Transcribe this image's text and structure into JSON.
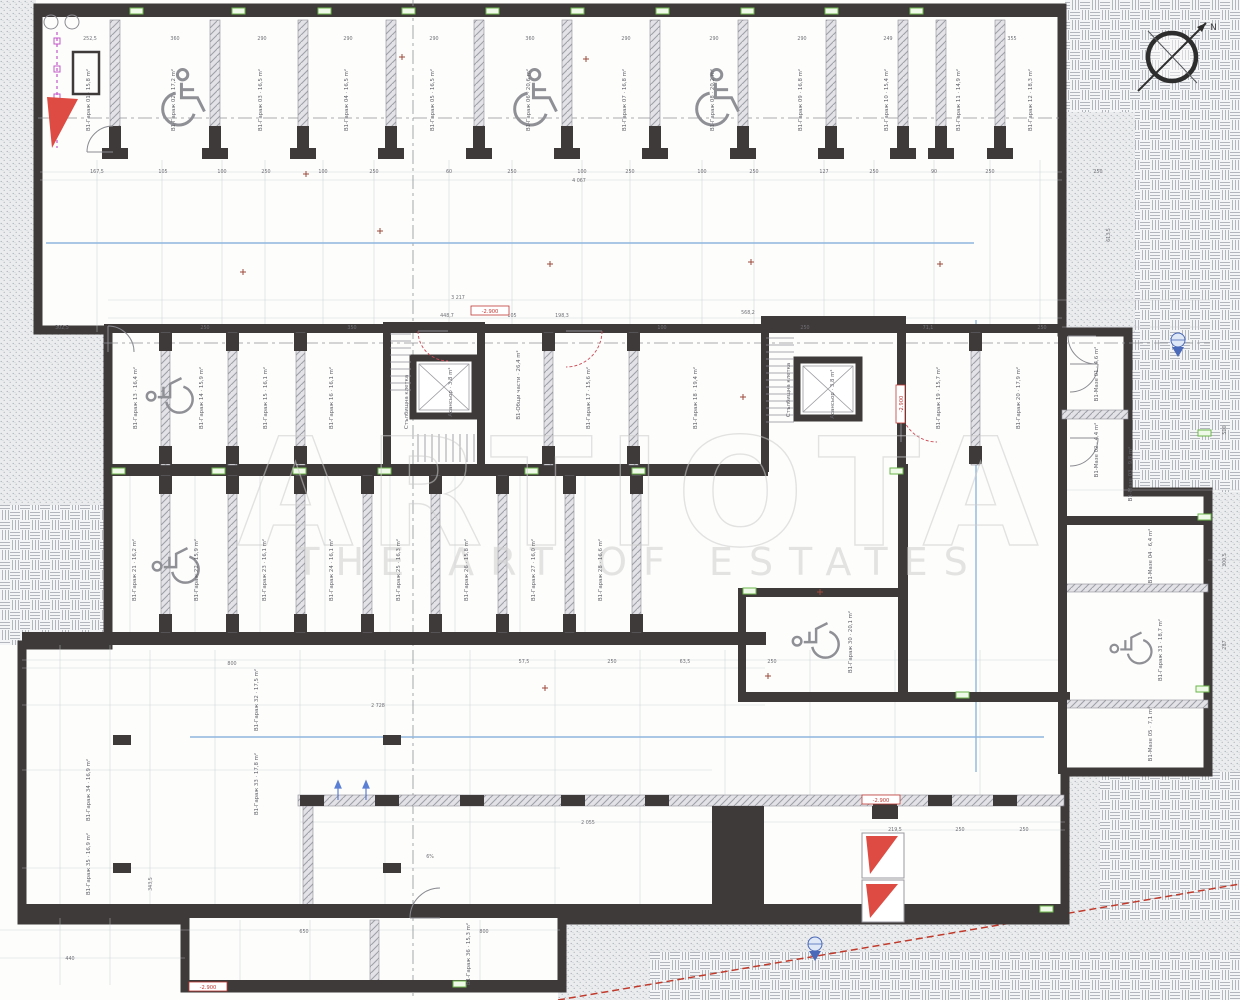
{
  "title": "Underground garage level floor plan",
  "watermark": {
    "brand": "ARTIOTA",
    "tagline": "THE ART OF ESTATES"
  },
  "compass": {
    "north_label": "N"
  },
  "colors": {
    "wall": "#3f3a3a",
    "ramp_red": "#dd4b43",
    "marker_green": "#6cb64a",
    "guide_blue": "#8fb6de",
    "utility_magenta": "#c257c8",
    "level_red": "#c03934"
  },
  "legend": {
    "dim_format": "[text, x, y, rot]"
  },
  "levels": [
    [
      "-2.900",
      490,
      313,
      0
    ],
    [
      "-2.900",
      903,
      404,
      -90
    ],
    [
      "-2.900",
      881,
      802,
      0
    ],
    [
      "-2.900",
      208,
      989,
      0
    ]
  ],
  "dims": [
    [
      "252,5",
      90,
      40,
      0
    ],
    [
      "360",
      175,
      40,
      0
    ],
    [
      "290",
      262,
      40,
      0
    ],
    [
      "290",
      348,
      40,
      0
    ],
    [
      "290",
      434,
      40,
      0
    ],
    [
      "360",
      530,
      40,
      0
    ],
    [
      "290",
      626,
      40,
      0
    ],
    [
      "290",
      714,
      40,
      0
    ],
    [
      "290",
      802,
      40,
      0
    ],
    [
      "249",
      888,
      40,
      0
    ],
    [
      "355",
      1012,
      40,
      0
    ],
    [
      "167,5",
      97,
      173,
      0
    ],
    [
      "105",
      163,
      173,
      0
    ],
    [
      "100",
      222,
      173,
      0
    ],
    [
      "250",
      266,
      173,
      0
    ],
    [
      "100",
      323,
      173,
      0
    ],
    [
      "250",
      374,
      173,
      0
    ],
    [
      "60",
      449,
      173,
      0
    ],
    [
      "250",
      512,
      173,
      0
    ],
    [
      "100",
      582,
      173,
      0
    ],
    [
      "250",
      630,
      173,
      0
    ],
    [
      "100",
      702,
      173,
      0
    ],
    [
      "250",
      754,
      173,
      0
    ],
    [
      "127",
      824,
      173,
      0
    ],
    [
      "250",
      874,
      173,
      0
    ],
    [
      "90",
      934,
      173,
      0
    ],
    [
      "250",
      990,
      173,
      0
    ],
    [
      "250",
      1098,
      173,
      0
    ],
    [
      "4 067",
      579,
      182,
      0
    ],
    [
      "3 217",
      458,
      299,
      0
    ],
    [
      "448,7",
      447,
      317,
      0
    ],
    [
      "105",
      512,
      317,
      0
    ],
    [
      "198,3",
      562,
      317,
      0
    ],
    [
      "568,2",
      748,
      314,
      0
    ],
    [
      "302,5",
      62,
      329,
      0
    ],
    [
      "250",
      205,
      329,
      0
    ],
    [
      "350",
      352,
      329,
      0
    ],
    [
      "100",
      662,
      329,
      0
    ],
    [
      "250",
      805,
      329,
      0
    ],
    [
      "71,1",
      928,
      329,
      0
    ],
    [
      "250",
      1042,
      329,
      0
    ],
    [
      "613,5",
      1110,
      235,
      -90
    ],
    [
      "500",
      1226,
      430,
      -90
    ],
    [
      "300,5",
      1226,
      560,
      -90
    ],
    [
      "287",
      1226,
      645,
      -90
    ],
    [
      "800",
      232,
      665,
      0
    ],
    [
      "57,5",
      524,
      663,
      0
    ],
    [
      "250",
      612,
      663,
      0
    ],
    [
      "63,5",
      685,
      663,
      0
    ],
    [
      "250",
      772,
      663,
      0
    ],
    [
      "2 728",
      378,
      707,
      0
    ],
    [
      "343,5",
      152,
      884,
      -90
    ],
    [
      "2 055",
      588,
      824,
      0
    ],
    [
      "6%",
      430,
      858,
      0
    ],
    [
      "219,5",
      895,
      831,
      0
    ],
    [
      "250",
      960,
      831,
      0
    ],
    [
      "250",
      1024,
      831,
      0
    ],
    [
      "650",
      304,
      933,
      0
    ],
    [
      "800",
      484,
      933,
      0
    ],
    [
      "440",
      70,
      960,
      0
    ]
  ],
  "rooms": [
    [
      "В1-Гараж 01 · 15,8 m²",
      90,
      100,
      -90
    ],
    [
      "В1-Гараж 02 · 17,2 m²",
      175,
      100,
      -90
    ],
    [
      "В1-Гараж 03 · 16,5 m²",
      262,
      100,
      -90
    ],
    [
      "В1-Гараж 04 · 16,5 m²",
      348,
      100,
      -90
    ],
    [
      "В1-Гараж 05 · 16,5 m²",
      434,
      100,
      -90
    ],
    [
      "В1-Гараж 06 · 20,6 m²",
      530,
      100,
      -90
    ],
    [
      "В1-Гараж 07 · 16,8 m²",
      626,
      100,
      -90
    ],
    [
      "В1-Гараж 08 · 20,2 m²",
      714,
      100,
      -90
    ],
    [
      "В1-Гараж 09 · 16,8 m²",
      802,
      100,
      -90
    ],
    [
      "В1-Гараж 10 · 15,4 m²",
      888,
      100,
      -90
    ],
    [
      "В1-Гараж 11 · 14,9 m²",
      960,
      100,
      -90
    ],
    [
      "В1-Гараж 12 · 18,3 m²",
      1032,
      100,
      -90
    ],
    [
      "В1-Гараж 13 · 16,4 m²",
      137,
      398,
      -90
    ],
    [
      "В1-Гараж 14 · 15,9 m²",
      203,
      398,
      -90
    ],
    [
      "В1-Гараж 15 · 16,1 m²",
      267,
      398,
      -90
    ],
    [
      "В1-Гараж 16 · 16,1 m²",
      333,
      398,
      -90
    ],
    [
      "В1-Общи части · 26,4 m²",
      520,
      385,
      -90
    ],
    [
      "В1-Гараж 17 · 15,6 m²",
      590,
      398,
      -90
    ],
    [
      "В1-Гараж 18 · 19,4 m²",
      697,
      398,
      -90
    ],
    [
      "В1-Гараж 19 · 15,7 m²",
      940,
      398,
      -90
    ],
    [
      "В1-Гараж 20 · 17,9 m²",
      1020,
      398,
      -90
    ],
    [
      "В1-Мазе 01 · 4,6 m²",
      1098,
      374,
      -90
    ],
    [
      "В1-Мазе 02 · 4,4 m²",
      1098,
      450,
      -90
    ],
    [
      "Стълбищна клетка",
      408,
      402,
      -90
    ],
    [
      "Асансьор · 3,8 m²",
      452,
      392,
      -90
    ],
    [
      "Стълбищна клетка",
      790,
      390,
      -90
    ],
    [
      "Асансьор · 3,8 m²",
      834,
      394,
      -90
    ],
    [
      "В1-Гараж 21 · 16,2 m²",
      136,
      570,
      -90
    ],
    [
      "В1-Гараж 22 · 15,9 m²",
      198,
      570,
      -90
    ],
    [
      "В1-Гараж 23 · 16,1 m²",
      266,
      570,
      -90
    ],
    [
      "В1-Гараж 24 · 16,1 m²",
      333,
      570,
      -90
    ],
    [
      "В1-Гараж 25 · 16,3 m²",
      400,
      570,
      -90
    ],
    [
      "В1-Гараж 26 · 15,8 m²",
      468,
      570,
      -90
    ],
    [
      "В1-Гараж 27 · 16,0 m²",
      535,
      570,
      -90
    ],
    [
      "В1-Гараж 28 · 16,6 m²",
      602,
      570,
      -90
    ],
    [
      "В1-Гараж 30 · 20,1 m²",
      852,
      642,
      -90
    ],
    [
      "В1-Мазе 03 · 9,8 m²",
      1132,
      474,
      -90
    ],
    [
      "В1-Мазе 04 · 6,4 m²",
      1152,
      556,
      -90
    ],
    [
      "В1-Гараж 31 · 18,7 m²",
      1162,
      650,
      -90
    ],
    [
      "В1-Мазе 05 · 7,1 m²",
      1152,
      734,
      -90
    ],
    [
      "В1-Гараж 32 · 17,5 m²",
      258,
      700,
      -90
    ],
    [
      "В1-Гараж 33 · 17,8 m²",
      258,
      784,
      -90
    ],
    [
      "В1-Гараж 34 · 16,9 m²",
      90,
      790,
      -90
    ],
    [
      "В1-Гараж 35 · 16,9 m²",
      90,
      864,
      -90
    ],
    [
      "В1-Гараж 36 · 15,3 m²",
      470,
      954,
      -90
    ]
  ]
}
